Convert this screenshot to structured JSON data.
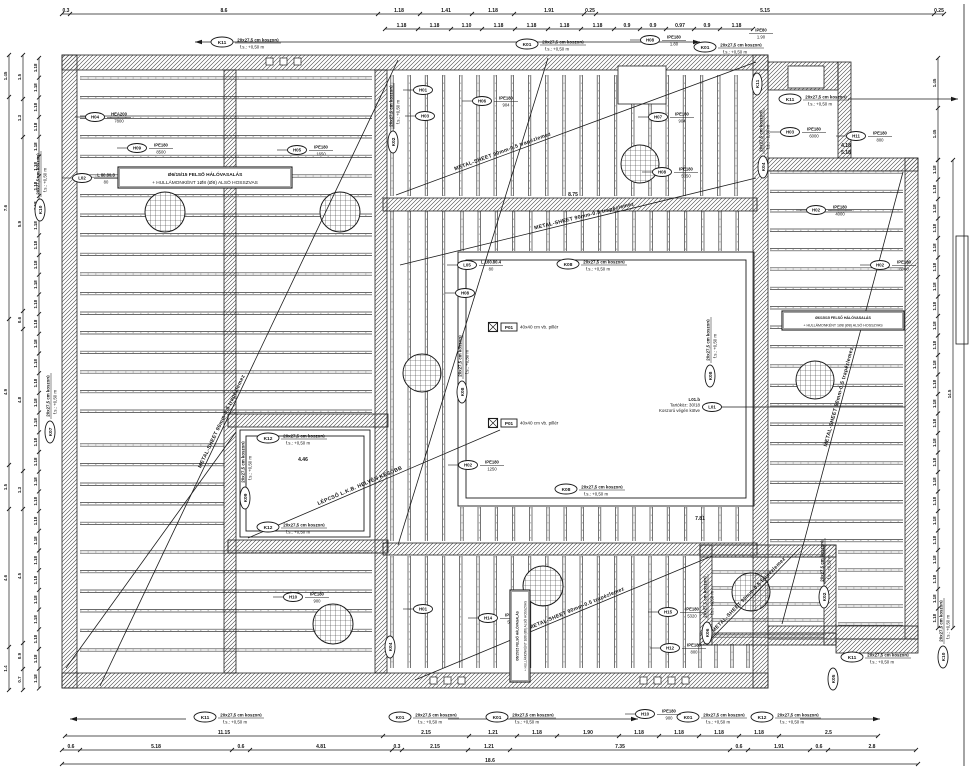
{
  "meta": {
    "drawing_type": "structural slab / ring-beam plan",
    "ink": "#1b1b1b",
    "bg": "#ffffff"
  },
  "strings": {
    "koszoru": "20x27,5 cm koszorú",
    "level": "f.s.: +0,50 m",
    "metal": "METAL-SHEET 90mm-0.5 trapézlemez",
    "stair": "LÉPCSŐ L.K.B. HELYÉN KÉSŐBB",
    "pillar_id": "P01",
    "pillar_text": "40x40 cm vb. pillér",
    "note_line1": "Ø6/15/15 FELSŐ HÁLÓVASALÁS",
    "note_line2": "+ HULLÁMONKÉNT 1Ø8 (Ø8) ALSÓ HOSSZVAS",
    "l01_id": "L01",
    "l01_lines": [
      "L01.b",
      "Tartóköz: 30/18",
      "Koszorú végén kötve"
    ]
  },
  "walls": [
    [
      62,
      55,
      706,
      15
    ],
    [
      62,
      55,
      15,
      633
    ],
    [
      62,
      673,
      706,
      15
    ],
    [
      753,
      55,
      15,
      633
    ],
    [
      768,
      158,
      150,
      13
    ],
    [
      905,
      158,
      13,
      481
    ],
    [
      768,
      626,
      150,
      13
    ],
    [
      768,
      62,
      70,
      28
    ],
    [
      838,
      62,
      13,
      96
    ],
    [
      383,
      198,
      374,
      13
    ],
    [
      224,
      70,
      12,
      603
    ],
    [
      375,
      70,
      12,
      603
    ],
    [
      228,
      414,
      160,
      13
    ],
    [
      228,
      540,
      160,
      13
    ],
    [
      383,
      543,
      374,
      12
    ],
    [
      700,
      545,
      12,
      100
    ],
    [
      700,
      545,
      136,
      12
    ],
    [
      824,
      545,
      12,
      100
    ],
    [
      700,
      633,
      136,
      12
    ],
    [
      836,
      639,
      82,
      14
    ]
  ],
  "rings": [
    [
      458,
      252,
      296,
      254
    ],
    [
      466,
      260,
      280,
      238
    ],
    [
      240,
      430,
      130,
      107
    ],
    [
      246,
      436,
      118,
      95
    ]
  ],
  "rooms": [
    [
      618,
      66,
      48,
      38
    ],
    [
      788,
      66,
      36,
      22
    ]
  ],
  "fields": [
    {
      "x": 80,
      "y": 78,
      "w": 292,
      "h": 347,
      "dir": "h",
      "gap": 19.6,
      "bg": false
    },
    {
      "x": 80,
      "y": 445,
      "w": 144,
      "h": 95,
      "dir": "h",
      "gap": 19.6,
      "bg": false
    },
    {
      "x": 80,
      "y": 552,
      "w": 292,
      "h": 116,
      "dir": "h",
      "gap": 19.6,
      "bg": false
    },
    {
      "x": 392,
      "y": 75,
      "w": 358,
      "h": 121,
      "dir": "v",
      "gap": 17.2,
      "bg": false
    },
    {
      "x": 392,
      "y": 211,
      "w": 63,
      "h": 330,
      "dir": "v",
      "gap": 17.2,
      "bg": false
    },
    {
      "x": 462,
      "y": 211,
      "w": 288,
      "h": 40,
      "dir": "v",
      "gap": 17.2,
      "bg": false
    },
    {
      "x": 462,
      "y": 507,
      "w": 288,
      "h": 34,
      "dir": "v",
      "gap": 17.2,
      "bg": false
    },
    {
      "x": 770,
      "y": 172,
      "w": 133,
      "h": 372,
      "dir": "h",
      "gap": 19.4,
      "bg": false
    },
    {
      "x": 838,
      "y": 552,
      "w": 65,
      "h": 72,
      "dir": "h",
      "gap": 18,
      "bg": false
    },
    {
      "x": 392,
      "y": 556,
      "w": 306,
      "h": 112,
      "dir": "v",
      "gap": 17.2,
      "bg": false
    },
    {
      "x": 700,
      "y": 644,
      "w": 50,
      "h": 24,
      "dir": "v",
      "gap": 16,
      "bg": false
    },
    {
      "x": 712,
      "y": 556,
      "w": 112,
      "h": 80,
      "dir": "h",
      "gap": 16,
      "bg": true
    }
  ],
  "circles": [
    [
      165,
      212,
      20
    ],
    [
      340,
      212,
      20
    ],
    [
      640,
      164,
      19
    ],
    [
      422,
      373,
      19
    ],
    [
      815,
      380,
      19
    ],
    [
      543,
      586,
      20
    ],
    [
      333,
      624,
      20
    ],
    [
      751,
      592,
      19
    ]
  ],
  "diagonals": [
    [
      100,
      686,
      398,
      60,
      "metal",
      0.42
    ],
    [
      66,
      668,
      236,
      432,
      "",
      0
    ],
    [
      396,
      195,
      756,
      62,
      "metal",
      0.3
    ],
    [
      400,
      265,
      756,
      178,
      "metal",
      0.52
    ],
    [
      415,
      680,
      712,
      556,
      "metal",
      0.55
    ],
    [
      782,
      624,
      903,
      172,
      "metal",
      0.5
    ],
    [
      712,
      638,
      800,
      548,
      "metal",
      0.45
    ],
    [
      248,
      538,
      500,
      430,
      "stair",
      0.45
    ],
    [
      398,
      545,
      548,
      58,
      "",
      0
    ]
  ],
  "kLabels": [
    [
      "K11",
      222,
      42,
      0,
      1
    ],
    [
      "K01",
      527,
      44,
      0,
      1
    ],
    [
      "K01",
      705,
      47,
      0,
      1
    ],
    [
      "K11",
      790,
      99,
      0,
      1
    ],
    [
      "K11",
      757,
      84,
      -90,
      0
    ],
    [
      "K02",
      393,
      142,
      -90,
      1
    ],
    [
      "K04",
      763,
      167,
      -90,
      1
    ],
    [
      "K08",
      568,
      264,
      0,
      1
    ],
    [
      "K08",
      566,
      489,
      0,
      1
    ],
    [
      "K08",
      462,
      392,
      -90,
      1
    ],
    [
      "K08",
      710,
      376,
      -90,
      1
    ],
    [
      "K12",
      268,
      438,
      0,
      1
    ],
    [
      "K12",
      268,
      527,
      0,
      1
    ],
    [
      "K09",
      245,
      498,
      -90,
      1
    ],
    [
      "K07",
      50,
      432,
      -90,
      1
    ],
    [
      "K10",
      40,
      210,
      -90,
      1
    ],
    [
      "K06",
      707,
      633,
      -90,
      1
    ],
    [
      "K02",
      824,
      597,
      -90,
      1
    ],
    [
      "K05",
      833,
      679,
      -90,
      0
    ],
    [
      "K04",
      390,
      647,
      -90,
      0
    ],
    [
      "K11",
      852,
      657,
      0,
      1
    ],
    [
      "K10",
      943,
      657,
      -90,
      1
    ],
    [
      "K11",
      205,
      717,
      0,
      1
    ],
    [
      "K01",
      400,
      717,
      0,
      1
    ],
    [
      "K01",
      497,
      717,
      0,
      1
    ],
    [
      "K01",
      688,
      717,
      0,
      1
    ],
    [
      "K12",
      762,
      717,
      0,
      1
    ]
  ],
  "beamLabels": [
    [
      "H04",
      95,
      117,
      "HEA200",
      "7800"
    ],
    [
      "H09",
      137,
      148,
      "IPE180",
      "8500"
    ],
    [
      "L02",
      82,
      178,
      "L 80.80.8",
      "80"
    ],
    [
      "H05",
      297,
      150,
      "IPE180",
      "1650"
    ],
    [
      "H01",
      423,
      90,
      "",
      ""
    ],
    [
      "H03",
      425,
      116,
      "",
      ""
    ],
    [
      "H06",
      482,
      101,
      "IPE180",
      "904"
    ],
    [
      "H07",
      658,
      117,
      "IPE180",
      "904"
    ],
    [
      "H08",
      662,
      172,
      "IPE180",
      "5050"
    ],
    [
      "H03",
      790,
      132,
      "IPE180",
      "6000"
    ],
    [
      "H11",
      856,
      136,
      "IPE180",
      "800"
    ],
    [
      "H02",
      816,
      210,
      "IPE180",
      "4000"
    ],
    [
      "H02",
      880,
      265,
      "IPE180",
      "6000"
    ],
    [
      "L05",
      467,
      265,
      "L 160.80.4",
      "80"
    ],
    [
      "H08",
      465,
      293,
      "",
      ""
    ],
    [
      "H02",
      468,
      465,
      "IPE180",
      "1250"
    ],
    [
      "H10",
      293,
      597,
      "IPE180",
      "900"
    ],
    [
      "H01",
      423,
      609,
      "",
      ""
    ],
    [
      "H14",
      488,
      618,
      "IPE180",
      "5320"
    ],
    [
      "H15",
      668,
      612,
      "IPE180",
      "5320"
    ],
    [
      "H12",
      670,
      648,
      "IPE180",
      "800"
    ],
    [
      "H10",
      645,
      714,
      "IPE180",
      "900"
    ],
    [
      "H08",
      650,
      40,
      "IPE180",
      "1.80"
    ],
    [
      "",
      748,
      33,
      "IPE80",
      "1.90"
    ]
  ],
  "pillars": [
    [
      493,
      327
    ],
    [
      493,
      423
    ]
  ],
  "noteBoxes": [
    [
      118,
      167,
      0,
      174,
      21,
      4.8
    ],
    [
      782,
      311,
      0,
      122,
      19,
      3.6
    ],
    [
      510,
      682,
      -90,
      92,
      20,
      3.2
    ]
  ],
  "l01": {
    "x": 712,
    "y": 407,
    "leader_x2": 905
  },
  "dims": [
    {
      "o": "h",
      "pos": 14,
      "from": 62,
      "segs": [
        [
          "0.3",
          8
        ],
        [
          "8.6",
          308
        ],
        [
          "1.18",
          42
        ],
        [
          "1.41",
          52
        ],
        [
          "1.18",
          42
        ],
        [
          "1.91",
          70
        ],
        [
          "0.25",
          12
        ],
        [
          "5.15",
          338
        ],
        [
          "0.25",
          10
        ]
      ]
    },
    {
      "o": "h",
      "pos": 29,
      "from": 385,
      "segs": [
        [
          "1.18",
          33
        ],
        [
          "1.18",
          33
        ],
        [
          "1.10",
          31
        ],
        [
          "1.18",
          33
        ],
        [
          "1.18",
          33
        ],
        [
          "1.18",
          33
        ],
        [
          "1.18",
          33
        ],
        [
          "0.9",
          26
        ],
        [
          "0.9",
          26
        ],
        [
          "0.97",
          28
        ],
        [
          "0.9",
          26
        ],
        [
          "1.18",
          33
        ]
      ]
    },
    {
      "o": "h",
      "pos": 736,
      "from": 65,
      "segs": [
        [
          "11.15",
          318
        ],
        [
          "2.15",
          86
        ],
        [
          "1.21",
          48
        ],
        [
          "1.18",
          40
        ],
        [
          "1.90",
          62
        ],
        [
          "1.18",
          40
        ],
        [
          "1.18",
          40
        ],
        [
          "1.18",
          40
        ],
        [
          "1.18",
          40
        ],
        [
          "2.5",
          99
        ]
      ]
    },
    {
      "o": "h",
      "pos": 750,
      "from": 62,
      "segs": [
        [
          "0.6",
          18
        ],
        [
          "5.18",
          152
        ],
        [
          "0.6",
          18
        ],
        [
          "4.81",
          142
        ],
        [
          "0.3",
          10
        ],
        [
          "2.15",
          66
        ],
        [
          "1.21",
          42
        ],
        [
          "7.35",
          220
        ],
        [
          "0.6",
          18
        ],
        [
          "1.91",
          62
        ],
        [
          "0.6",
          18
        ],
        [
          "2.8",
          88
        ]
      ]
    },
    {
      "o": "h",
      "pos": 764,
      "from": 62,
      "segs": [
        [
          "18.6",
          856
        ]
      ]
    },
    {
      "o": "v",
      "pos": 9,
      "from": 55,
      "segs": [
        [
          "1.45",
          42
        ],
        [
          "7.6",
          222
        ],
        [
          "4.9",
          146
        ],
        [
          "1.5",
          44
        ],
        [
          "4.6",
          138
        ],
        [
          "1.4",
          43
        ]
      ]
    },
    {
      "o": "v",
      "pos": 23,
      "from": 55,
      "segs": [
        [
          "1.5",
          44
        ],
        [
          "1.3",
          38
        ],
        [
          "5.9",
          174
        ],
        [
          "0.6",
          18
        ],
        [
          "4.8",
          142
        ],
        [
          "1.3",
          38
        ],
        [
          "4.5",
          134
        ],
        [
          "0.9",
          26
        ],
        [
          "0.7",
          21
        ]
      ]
    },
    {
      "o": "v",
      "pos": 39,
      "from": 58,
      "rep": [
        "1.18",
        19.7,
        32
      ]
    },
    {
      "o": "v",
      "pos": 938,
      "from": 160,
      "rep": [
        "1.18",
        19.5,
        24
      ]
    },
    {
      "o": "v",
      "pos": 953,
      "from": 160,
      "segs": [
        [
          "14.5",
          468
        ]
      ]
    },
    {
      "o": "v",
      "pos": 938,
      "from": 58,
      "segs": [
        [
          "1.45",
          50
        ],
        [
          "1.45",
          52
        ]
      ]
    }
  ],
  "arrows": [
    [
      195,
      42,
      700,
      42,
      "b"
    ],
    [
      848,
      99,
      958,
      99,
      "r"
    ],
    [
      70,
      719,
      186,
      719,
      "l"
    ],
    [
      448,
      719,
      638,
      719,
      "r"
    ],
    [
      800,
      719,
      880,
      719,
      "r"
    ]
  ],
  "texts": [
    [
      "8.75",
      573,
      196,
      0
    ],
    [
      "4.46",
      303,
      461,
      0
    ],
    [
      "4.18",
      846,
      147,
      0
    ],
    [
      "5.18",
      846,
      154,
      0
    ],
    [
      "7.81",
      700,
      520,
      0
    ]
  ],
  "squares": [
    [
      430,
      677
    ],
    [
      444,
      677
    ],
    [
      458,
      677
    ],
    [
      640,
      677
    ],
    [
      654,
      677
    ],
    [
      668,
      677
    ],
    [
      682,
      677
    ],
    [
      266,
      58
    ],
    [
      280,
      58
    ],
    [
      294,
      58
    ]
  ],
  "legendBox": [
    956,
    236,
    12,
    108
  ],
  "frameLine": [
    964,
    4,
    964,
    766
  ]
}
